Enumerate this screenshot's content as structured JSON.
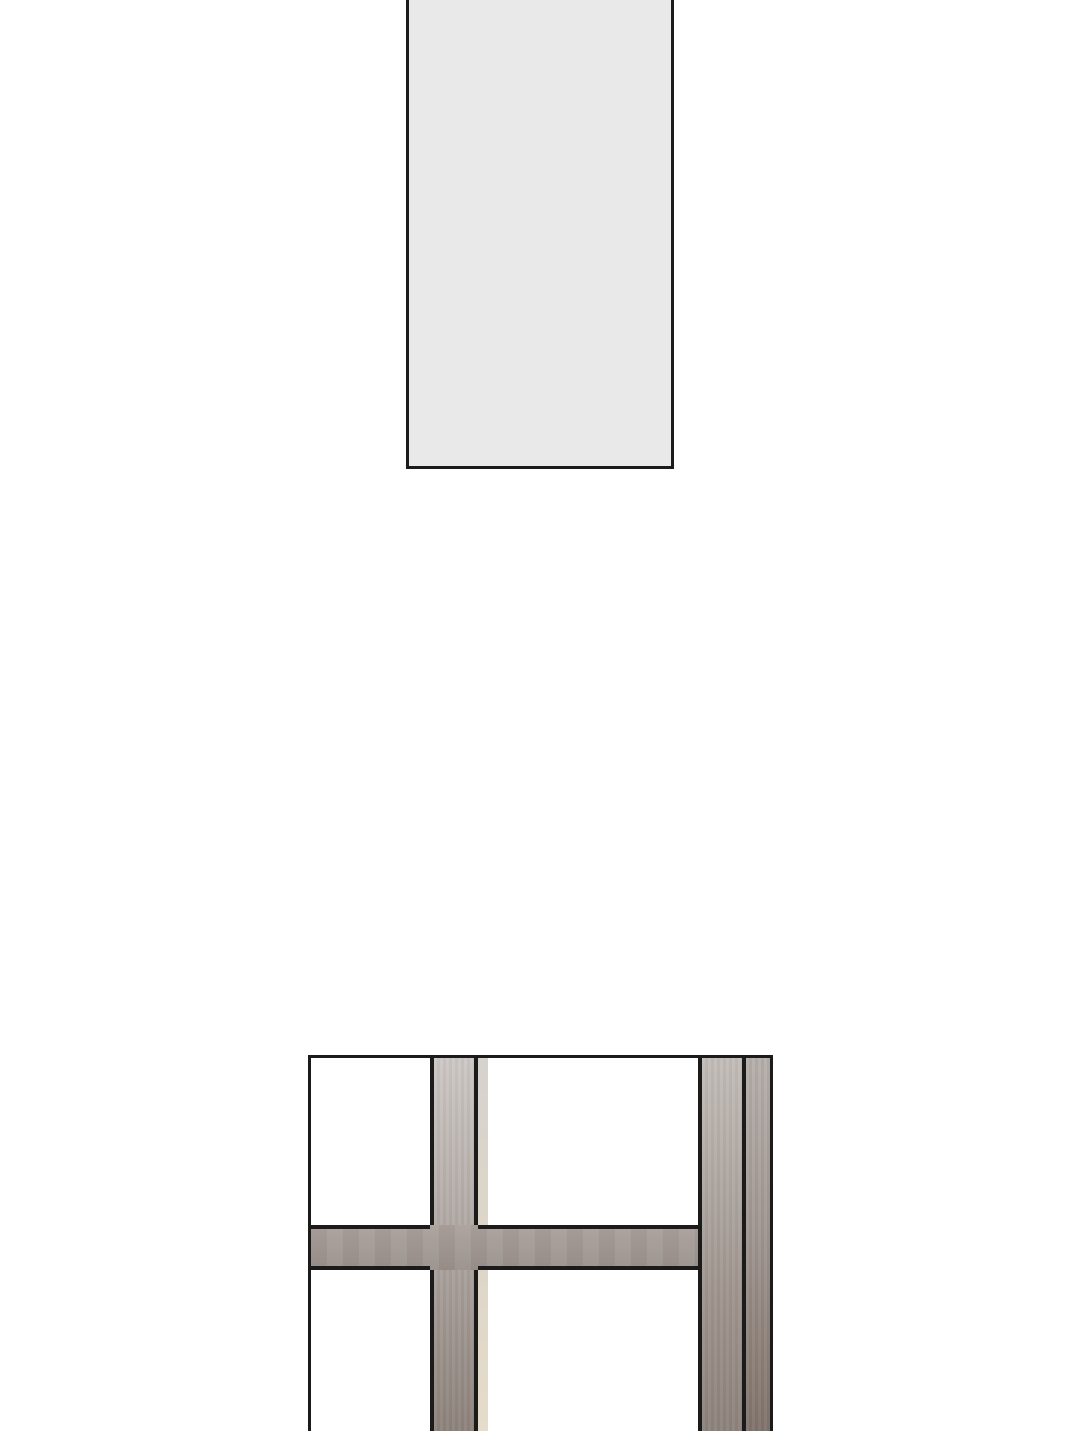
{
  "page": {
    "kind": "vertical comic strip segment",
    "background_label": "white gutter"
  },
  "colors": {
    "page-bg": "#ffffff",
    "ink": "#1b1b1b",
    "panel-fill": "#e9e9e9",
    "frame-gray-top": "#cdc8c5",
    "frame-gray-mid": "#a69d98",
    "frame-gray-dark": "#8e837c",
    "frame-gray-darker": "#80746d",
    "strip-gray-top": "#b6b0ac",
    "transom-gray-top": "#aba29d",
    "transom-gray-bottom": "#9a918b",
    "highlight-strip-top": "#d6d2cd",
    "highlight-strip-bottom": "#e5dccb"
  },
  "panels": {
    "top": {
      "label": "Empty light-gray panel cropped by the top edge of the page"
    },
    "window": {
      "label": "Close-up of a gray window frame with a center mullion, right mullion and horizontal transom, white panes, cropped by the bottom edge of the page"
    }
  }
}
